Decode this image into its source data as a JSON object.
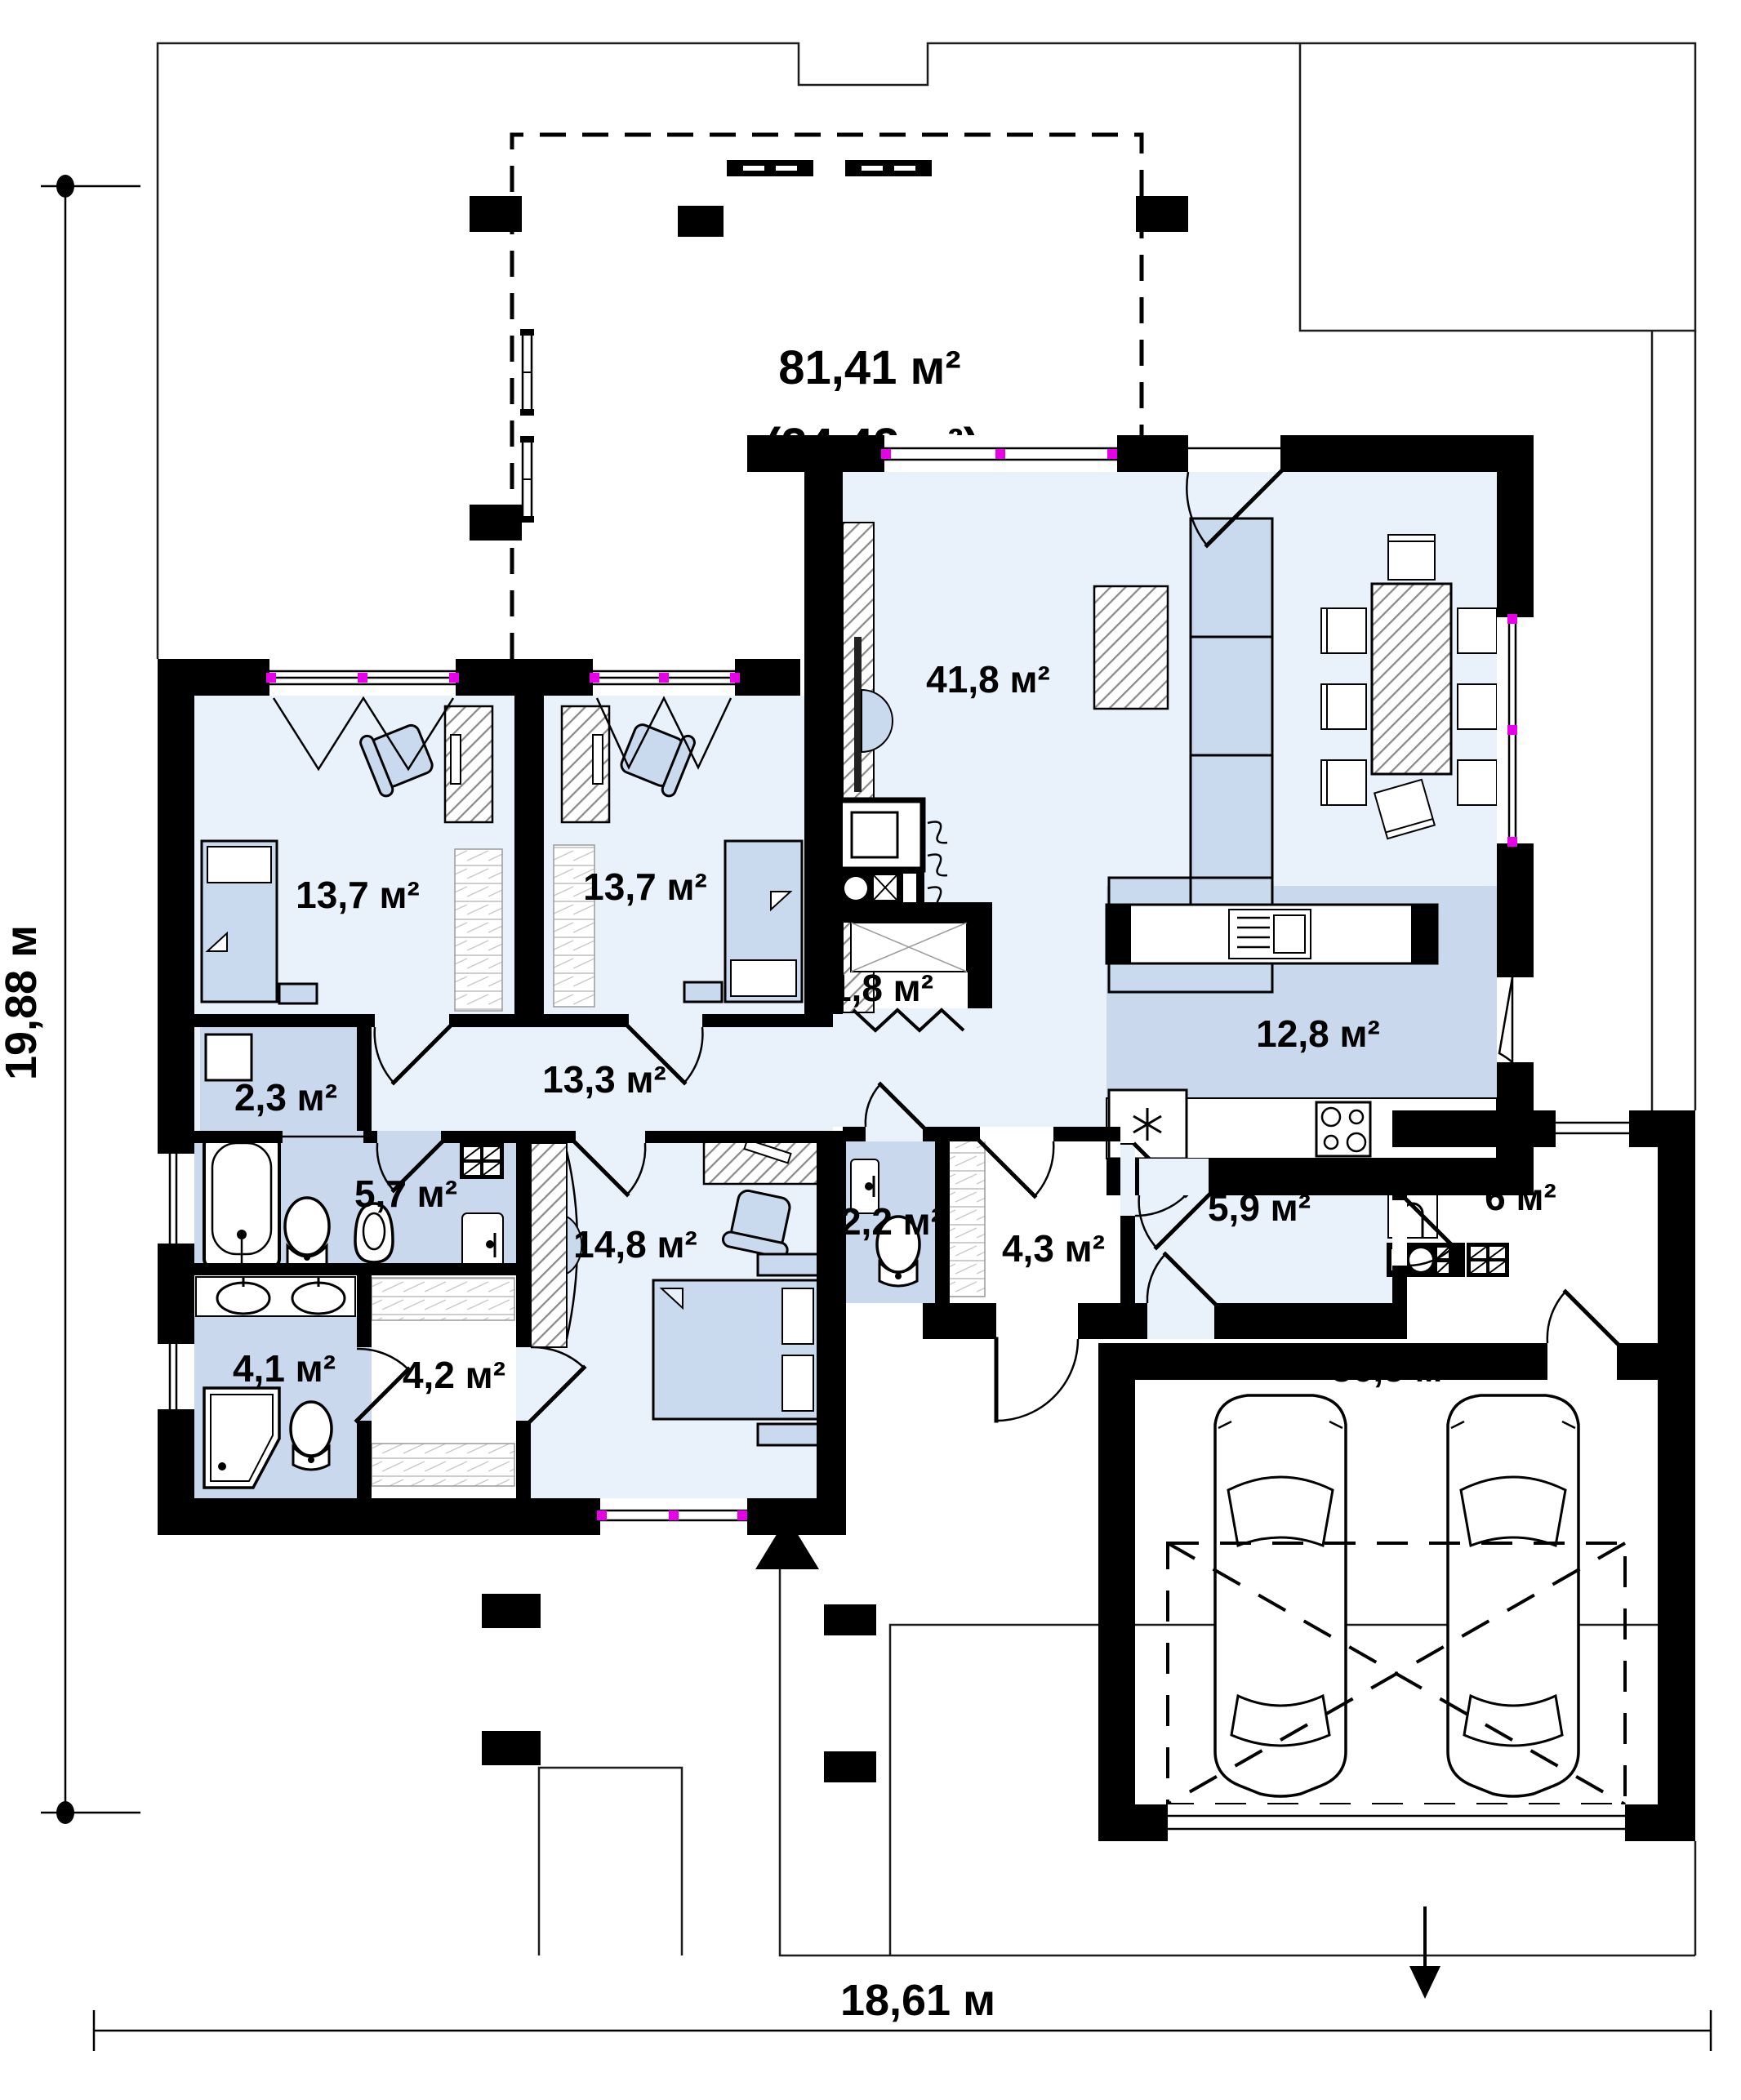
{
  "plan": {
    "terrace": {
      "area_total": "81,41 м²",
      "area_covered": "(24,42 м²)"
    },
    "rooms": {
      "living_room": {
        "area": "41,8 м²"
      },
      "bedroom_1": {
        "area": "13,7 м²"
      },
      "bedroom_2": {
        "area": "13,7 м²"
      },
      "pantry": {
        "area": "1,8 м²"
      },
      "kitchen": {
        "area": "12,8 м²"
      },
      "hallway": {
        "area": "13,3 м²"
      },
      "laundry": {
        "area": "2,3 м²"
      },
      "bathroom": {
        "area": "5,7 м²"
      },
      "master_bedroom": {
        "area": "14,8 м²"
      },
      "wc": {
        "area": "2,2 м²"
      },
      "entry": {
        "area": "4,3 м²"
      },
      "hall": {
        "area": "5,9 м²"
      },
      "utility": {
        "area": "6 м²"
      },
      "shower_room": {
        "area": "4,1 м²"
      },
      "wardrobe": {
        "area": "4,2 м²"
      },
      "garage": {
        "area": "36,5 м²"
      }
    },
    "dimensions": {
      "height": "19,88 м",
      "width": "18,61 м"
    }
  }
}
